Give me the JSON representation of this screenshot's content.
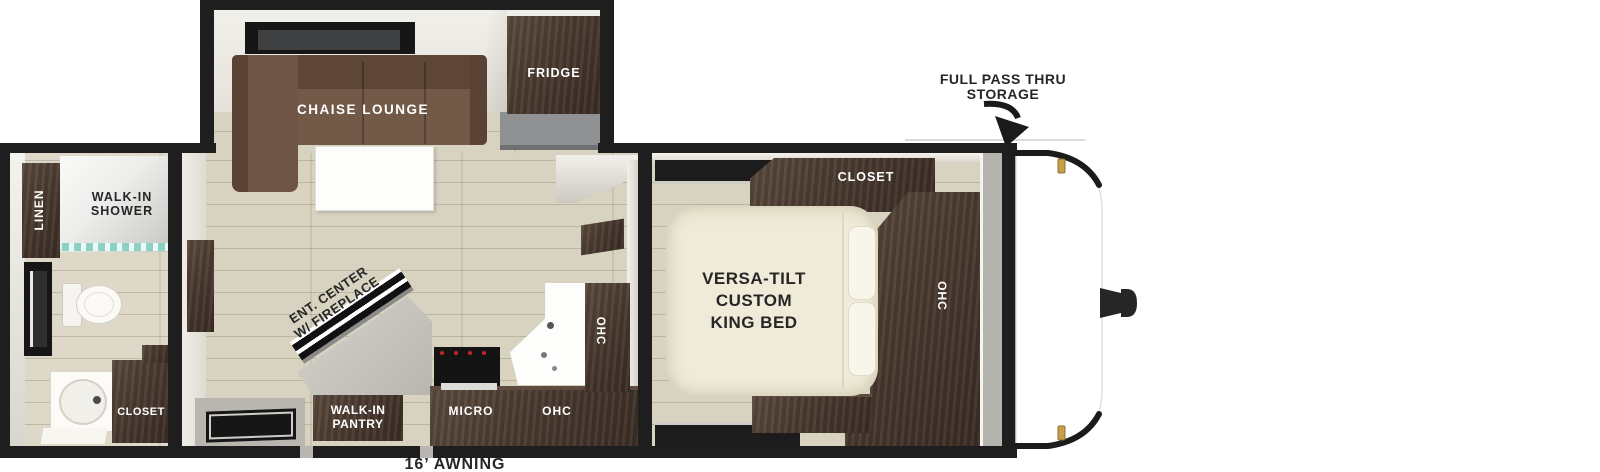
{
  "title": "Travel trailer floor plan",
  "callouts": {
    "storage_line1": "FULL PASS THRU",
    "storage_line2": "STORAGE",
    "awning": "16’ AWNING"
  },
  "bathroom": {
    "linen": "LINEN",
    "shower_line1": "WALK-IN",
    "shower_line2": "SHOWER",
    "closet": "CLOSET"
  },
  "living": {
    "chaise": "CHAISE LOUNGE",
    "fridge": "FRIDGE",
    "ent_line1": "ENT. CENTER",
    "ent_line2": "W/ FIREPLACE",
    "pantry_line1": "WALK-IN",
    "pantry_line2": "PANTRY",
    "micro": "MICRO",
    "ohc_base": "OHC",
    "ohc_upper": "OHC"
  },
  "bedroom": {
    "bed_line1": "VERSA-TILT",
    "bed_line2": "CUSTOM",
    "bed_line3": "KING BED",
    "closet": "CLOSET",
    "ohc": "OHC"
  },
  "colors": {
    "wall": "#1e1e1e",
    "floor": "#d8d3c1",
    "cabinet_dark": "#4a3a30",
    "sofa_brown": "#6e5545",
    "bed_cream": "#f0ebd8",
    "glass_teal": "#8fd0c4",
    "marker_gold": "#c9a04a",
    "storage_gray": "#b5b3ae"
  }
}
